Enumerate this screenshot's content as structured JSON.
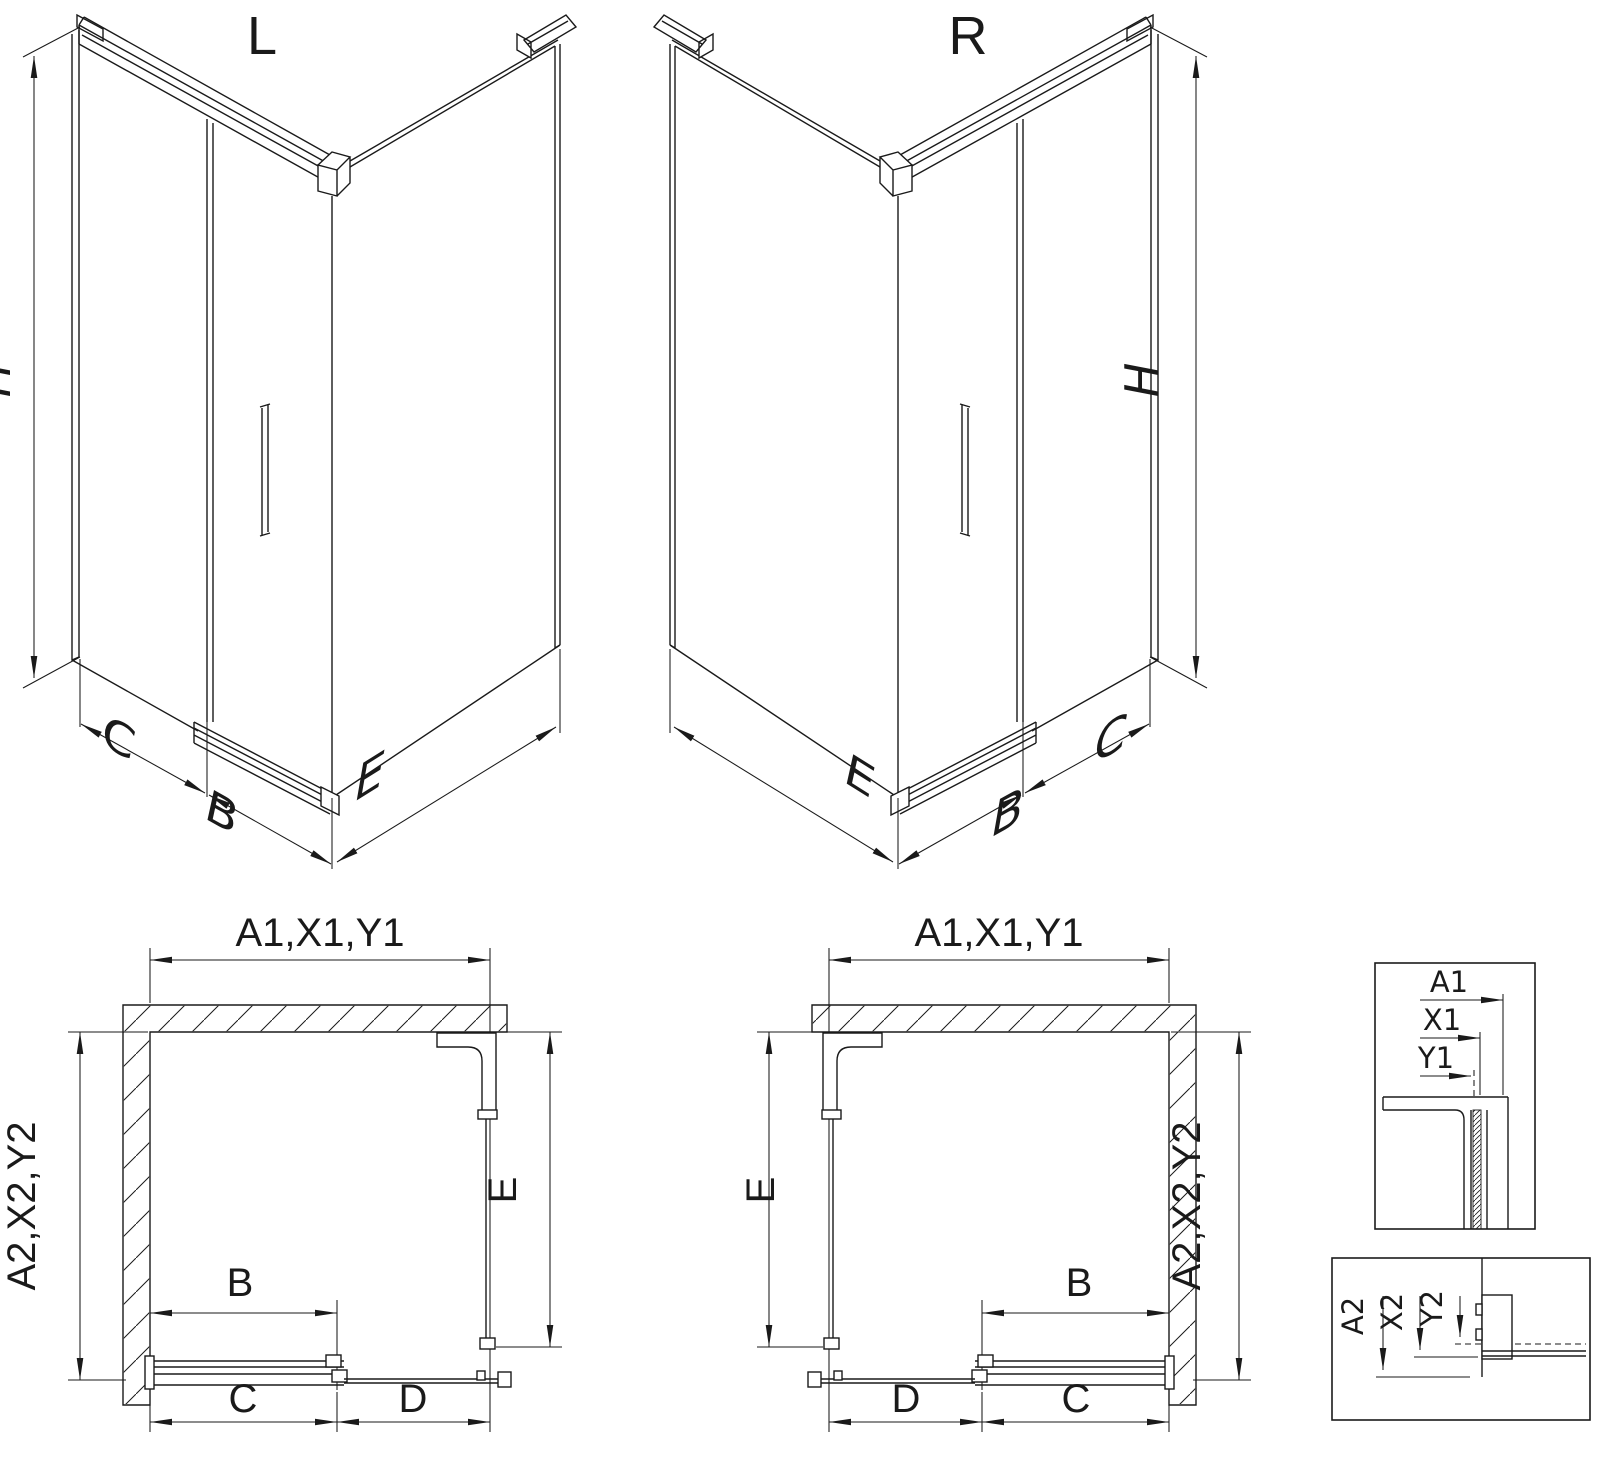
{
  "diagram": {
    "colors": {
      "line": "#1a1a1a",
      "background": "#ffffff"
    },
    "iso_left": {
      "title": "L",
      "dim_height": "H",
      "dim_side_panel": "C",
      "dim_door": "B",
      "dim_return_panel": "E"
    },
    "iso_right": {
      "title": "R",
      "dim_height": "H",
      "dim_side_panel": "C",
      "dim_door": "B",
      "dim_return_panel": "E"
    },
    "plan_left": {
      "dim_top": "A1,X1,Y1",
      "dim_left": "A2,X2,Y2",
      "dim_right": "E",
      "dim_door": "B",
      "dim_bottom_first": "C",
      "dim_bottom_second": "D"
    },
    "plan_right": {
      "dim_top": "A1,X1,Y1",
      "dim_right": "A2,X2,Y2",
      "dim_left": "E",
      "dim_door": "B",
      "dim_bottom_first": "D",
      "dim_bottom_second": "C"
    },
    "detail_top": {
      "dim1": "A1",
      "dim2": "X1",
      "dim3": "Y1"
    },
    "detail_bottom": {
      "dim1": "A2",
      "dim2": "X2",
      "dim3": "Y2"
    }
  }
}
